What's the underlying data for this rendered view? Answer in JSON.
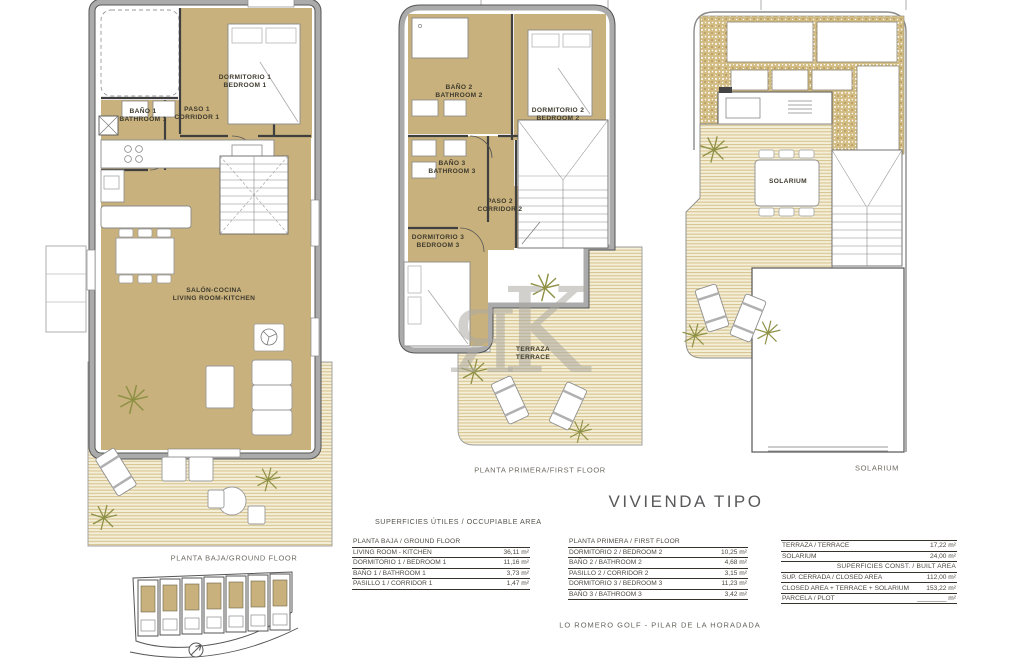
{
  "title": "VIVIENDA TIPO",
  "location": "LO ROMERO GOLF   -   PILAR DE LA HORADADA",
  "watermark": {
    "char1": "Я",
    "char2": "K"
  },
  "section_title": "SUPERFICIES ÚTILES / OCCUPIABLE AREA",
  "plans": {
    "ground": {
      "caption": "PLANTA BAJA/GROUND FLOOR",
      "labels": {
        "bathroom1": "BAÑO 1\nBATHROOM 1",
        "corridor1": "PASO 1\nCORRIDOR 1",
        "bedroom1": "DORMITORIO 1\nBEDROOM 1",
        "living": "SALÓN-COCINA\nLIVING ROOM-KITCHEN"
      }
    },
    "first": {
      "caption": "PLANTA PRIMERA/FIRST FLOOR",
      "labels": {
        "bathroom2": "BAÑO 2\nBATHROOM 2",
        "bedroom2": "DORMITORIO 2\nBEDROOM 2",
        "bathroom3": "BAÑO 3\nBATHROOM 3",
        "corridor2": "PASO 2\nCORRIDOR 2",
        "bedroom3": "DORMITORIO 3\nBEDROOM 3",
        "terrace": "TERRAZA\nTERRACE"
      }
    },
    "solarium": {
      "caption": "SOLARIUM",
      "labels": {
        "solarium": "SOLARIUM"
      }
    }
  },
  "tables": {
    "ground": {
      "header": "PLANTA BAJA / GROUND FLOOR",
      "rows": [
        {
          "label": "LIVING ROOM - KITCHEN",
          "value": "36,11 m²"
        },
        {
          "label": "DORMITORIO 1 /  BEDROOM 1",
          "value": "11,16 m²"
        },
        {
          "label": "BAÑO 1 / BATHROOM 1",
          "value": "3,73 m²"
        },
        {
          "label": "PASILLO 1 / CORRIDOR 1",
          "value": "1,47 m²"
        }
      ]
    },
    "first": {
      "header": "PLANTA PRIMERA / FIRST FLOOR",
      "rows": [
        {
          "label": "DORMITORIO 2 / BEDROOM 2",
          "value": "10,25 m²"
        },
        {
          "label": "BAÑO 2 / BATHROOM 2",
          "value": "4,68 m²"
        },
        {
          "label": "PASILLO 2 / CORRIDOR 2",
          "value": "3,15 m²"
        },
        {
          "label": "DORMITORIO 3 / BEDROOM 3",
          "value": "11,23 m²"
        },
        {
          "label": "BAÑO 3 / BATHROOM 3",
          "value": "3,42 m²"
        }
      ]
    },
    "built": {
      "subheader": "SUPERFICIES  CONST. / BUILT AREA",
      "rows_top": [
        {
          "label": "TERRAZA / TERRACE",
          "value": "17,22 m²"
        },
        {
          "label": "SOLARIUM",
          "value": "24,00 m²"
        }
      ],
      "rows_bottom": [
        {
          "label": "SUP. CERRADA / CLOSED AREA",
          "value": "112,00 m²"
        },
        {
          "label": "CLOSED AREA + TERRACE + SOLARIUM",
          "value": "153,22 m²"
        },
        {
          "label": "PARCELA / PLOT",
          "value": "________ m²"
        }
      ]
    }
  },
  "colors": {
    "room_fill": "#c8b17c",
    "terrace_stripe_bg": "#f4efd8",
    "terrace_stripe_line": "#d8c48f",
    "wall_gray": "#a9a9a9",
    "line_dark": "#3f3f3f"
  }
}
